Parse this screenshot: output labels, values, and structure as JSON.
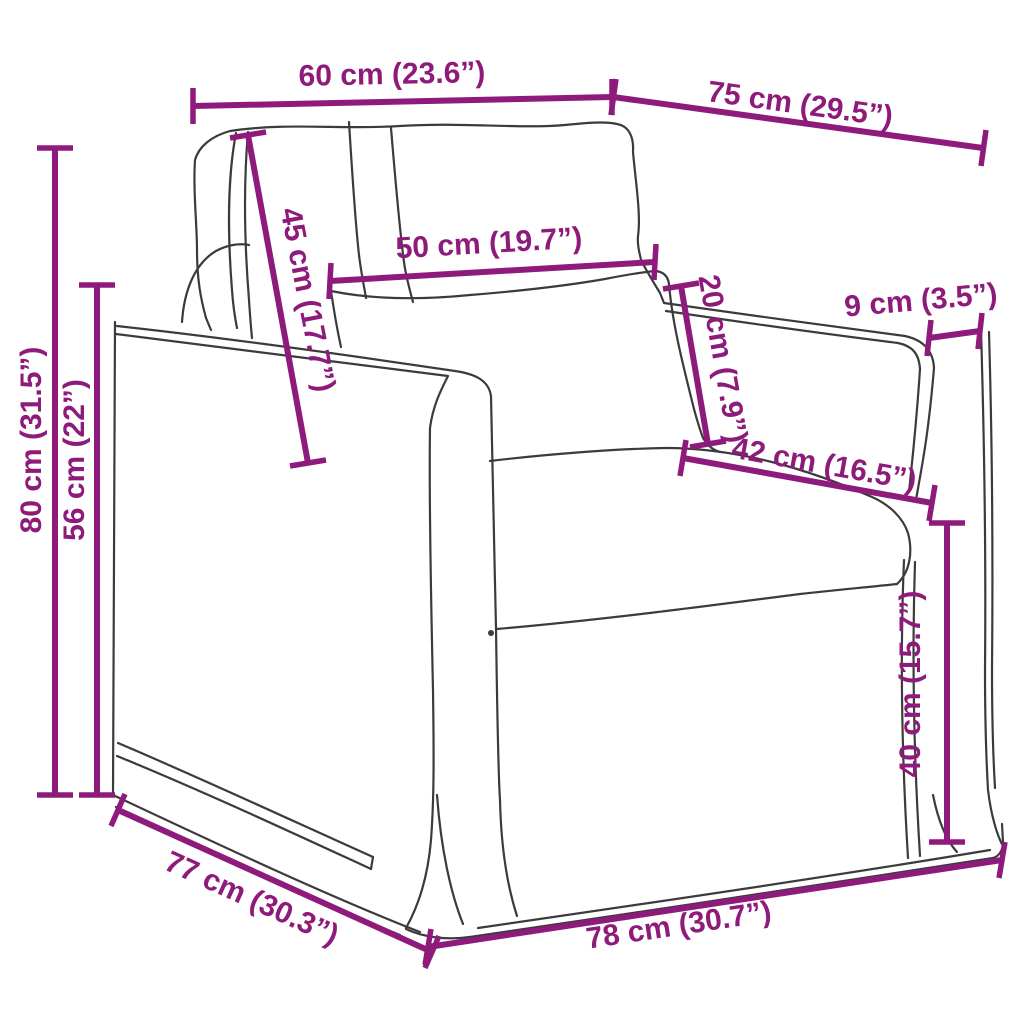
{
  "diagram": {
    "subject": "armchair-line-drawing",
    "style": "technical dimension diagram",
    "background_color": "#ffffff",
    "dimension_color": "#8E1B7B",
    "drawing_color": "#3b3b3b"
  },
  "dimensions": [
    {
      "id": "backrest-top-width",
      "label": "60 cm (23.6”)",
      "cm": 60,
      "inch": 23.6
    },
    {
      "id": "top-depth",
      "label": "75 cm (29.5”)",
      "cm": 75,
      "inch": 29.5
    },
    {
      "id": "total-height",
      "label": "80 cm (31.5”)",
      "cm": 80,
      "inch": 31.5
    },
    {
      "id": "armrest-height",
      "label": "56 cm (22”)",
      "cm": 56,
      "inch": 22
    },
    {
      "id": "back-cushion-length",
      "label": "45 cm (17.7”)",
      "cm": 45,
      "inch": 17.7
    },
    {
      "id": "seat-cushion-width",
      "label": "50 cm (19.7”)",
      "cm": 50,
      "inch": 19.7
    },
    {
      "id": "cushion-thickness",
      "label": "20 cm (7.9”)",
      "cm": 20,
      "inch": 7.9
    },
    {
      "id": "armrest-width",
      "label": "9 cm (3.5”)",
      "cm": 9,
      "inch": 3.5
    },
    {
      "id": "seat-depth",
      "label": "42 cm (16.5”)",
      "cm": 42,
      "inch": 16.5
    },
    {
      "id": "seat-height",
      "label": "40 cm (15.7”)",
      "cm": 40,
      "inch": 15.7
    },
    {
      "id": "base-depth",
      "label": "77 cm (30.3”)",
      "cm": 77,
      "inch": 30.3
    },
    {
      "id": "base-front-width",
      "label": "78 cm (30.7”)",
      "cm": 78,
      "inch": 30.7
    }
  ]
}
